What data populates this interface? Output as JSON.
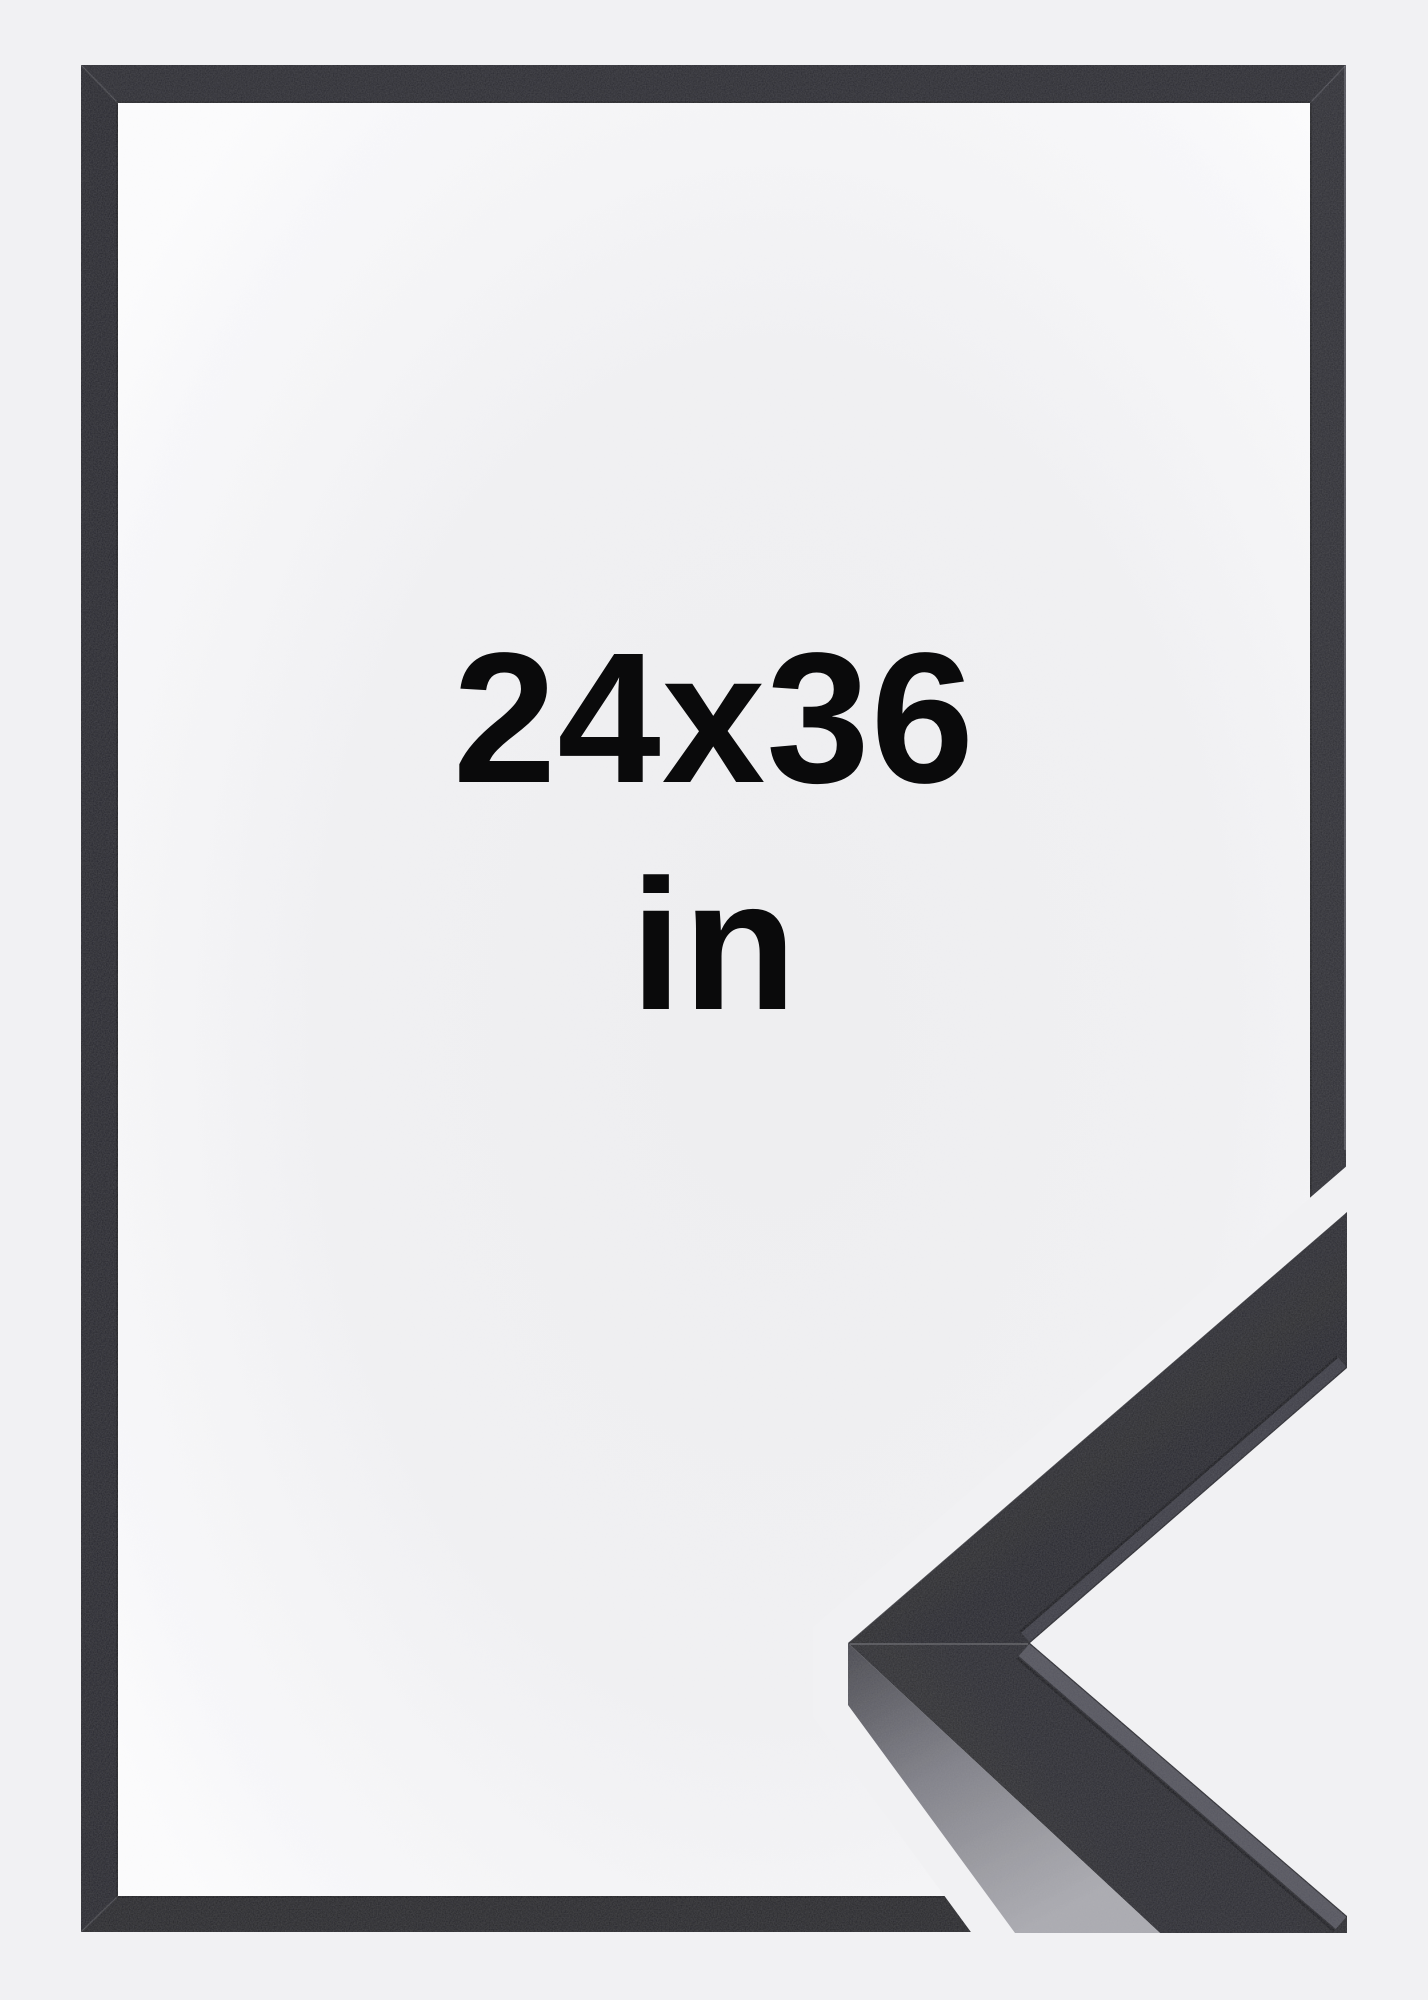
{
  "frame_label": {
    "size": "24x36",
    "unit": "in"
  },
  "colors": {
    "bg": "#f1f1f3",
    "gap": "#f1f1f3",
    "frame-top": "#2a2a31",
    "frame-right": "#2e2e36",
    "frame-bottom": "#26262c",
    "frame-left": "#28282e",
    "sample-face": "#2b2b31",
    "sample-side-light": "#a9a9af",
    "text": "#0a0a0b"
  }
}
